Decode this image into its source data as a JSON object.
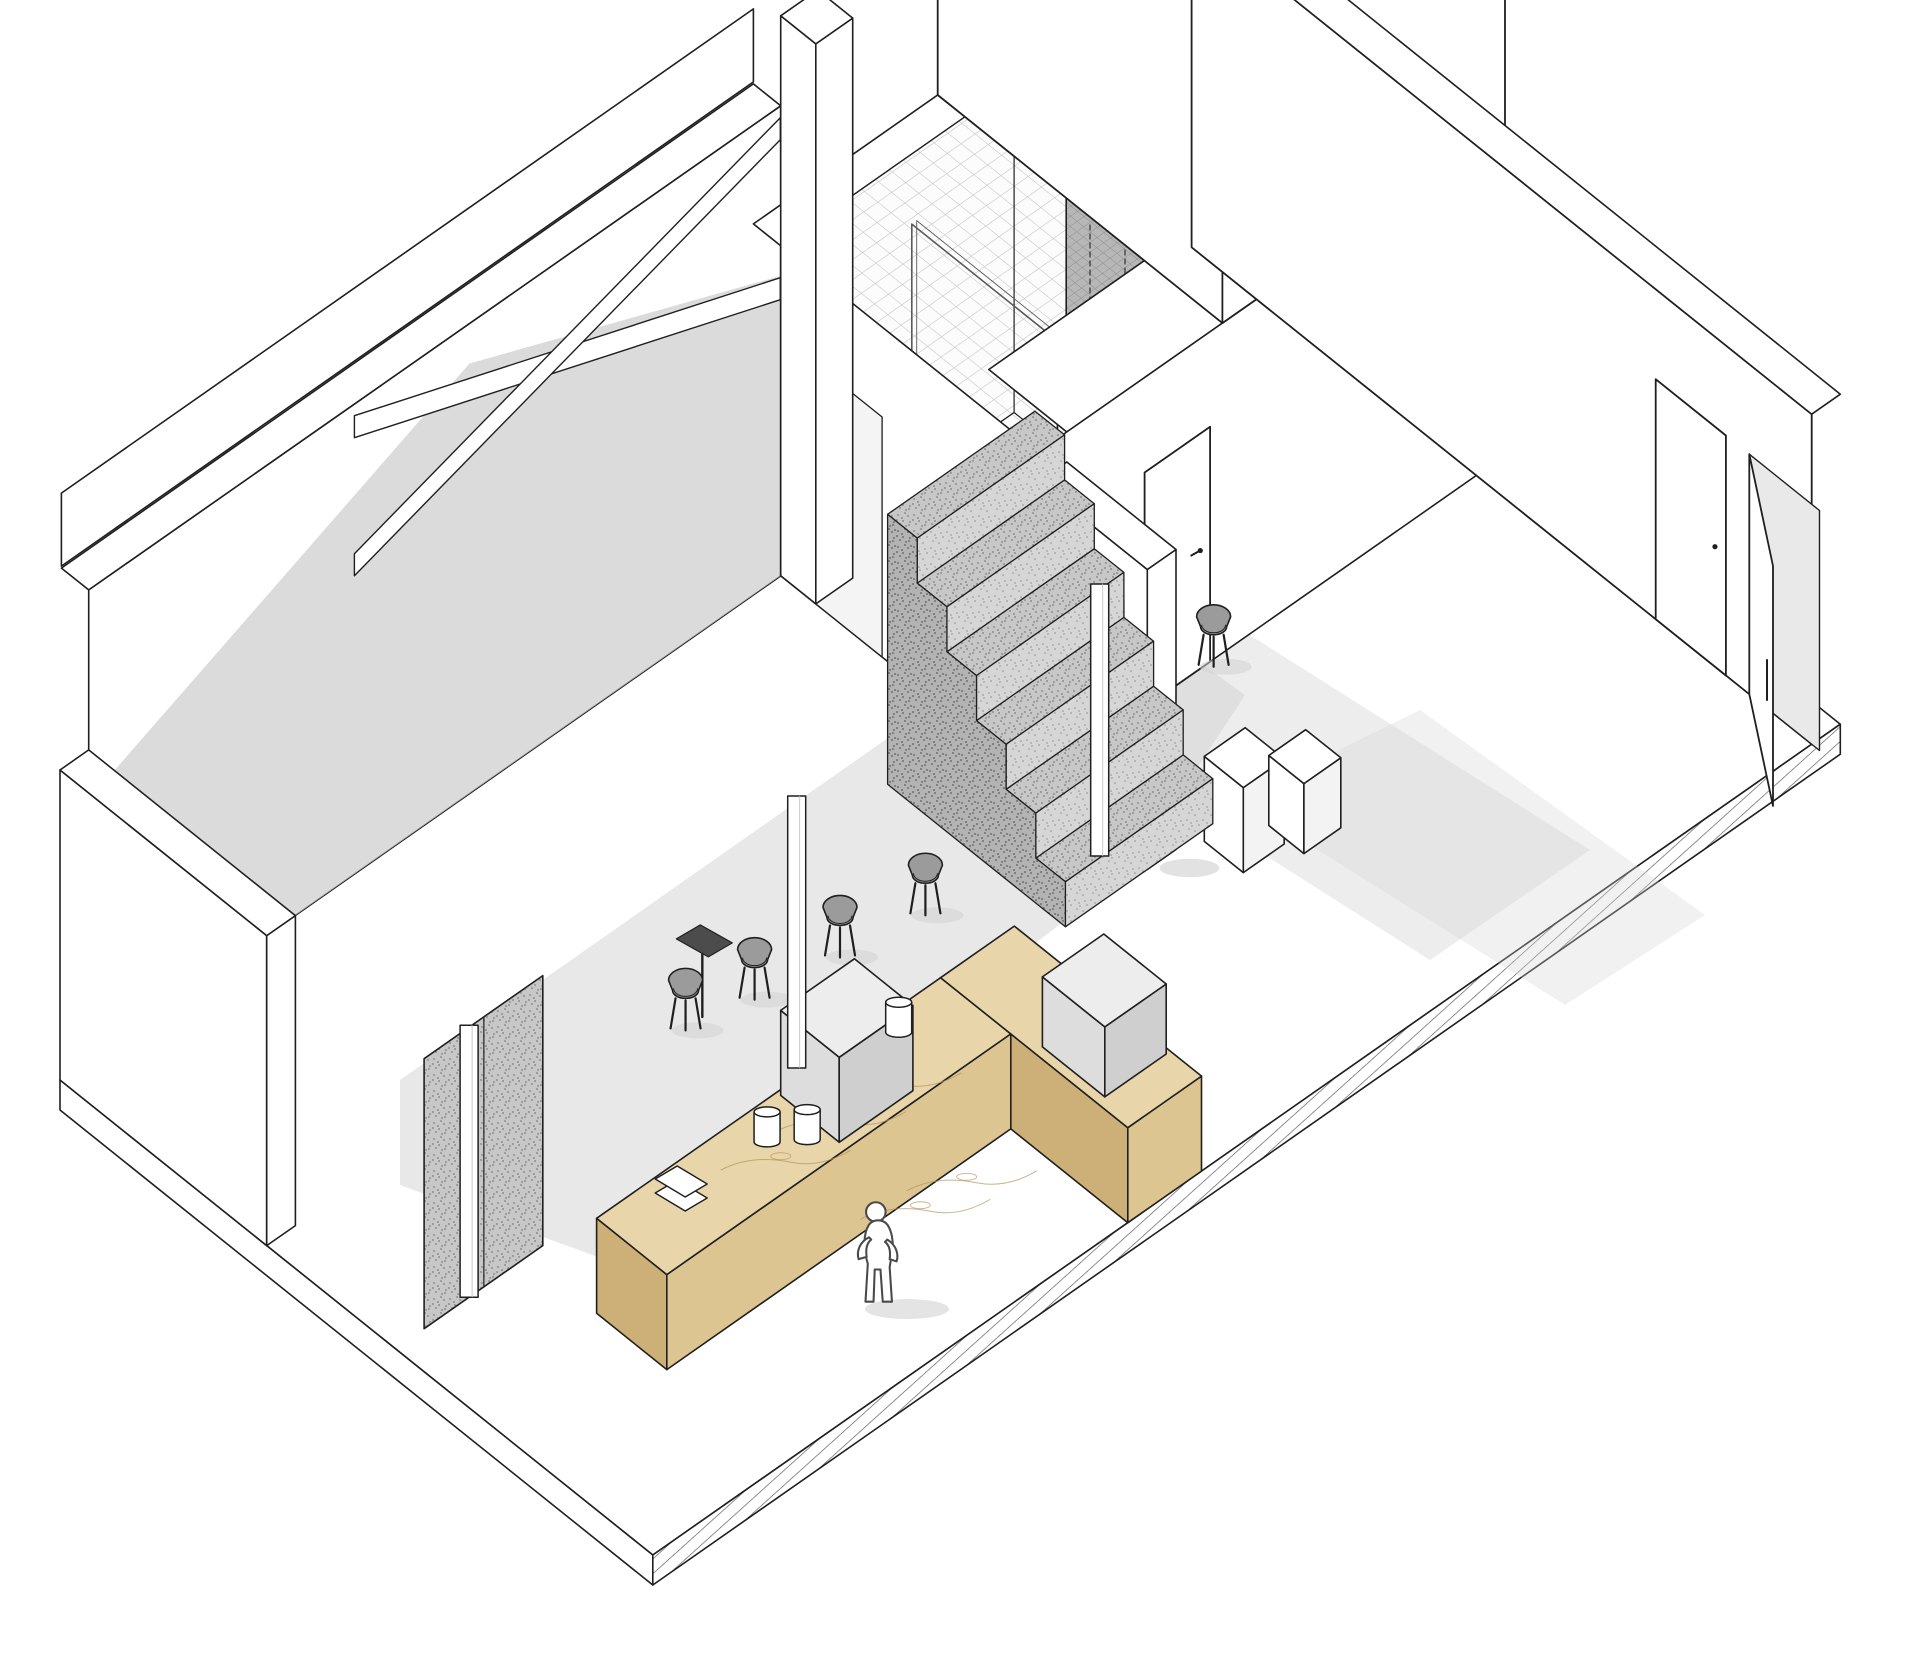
{
  "page": {
    "background": "#ffffff",
    "width": 1920,
    "height": 1671
  },
  "drawing": {
    "type": "axonometric-cutaway",
    "subject": "Two-level cafe interior axonometric cutaway drawing",
    "style": "monochrome architectural line drawing with wood, tan and speckled concrete accents",
    "colors": {
      "line": "#1f1f1f",
      "soft_line": "#5a5a5a",
      "paper": "#ffffff",
      "shadow": "#d2d2d2",
      "wall_shade": "#cfcfcf",
      "wood_top": "#e8d5a9",
      "wood_front": "#ddc592",
      "wood_side": "#cdb077",
      "wood_grain": "#b2945c",
      "sofa_top": "#decdb8",
      "sofa_front": "#d3bfa6",
      "sofa_side": "#c3ac90",
      "concrete": "#c7c7c7",
      "concrete_light": "#d6d6d6",
      "concrete_dark": "#b3b3b3",
      "speckle": "#7f7f7f",
      "floor_tile_bg": "#fcfcfc",
      "tile_line": "#c6c6c6",
      "tile_gray": "#b7b7b7",
      "tile_gray_line": "#8f8f8f",
      "chair_shell": "#9b9b9b",
      "glass": "#ededed",
      "figure": "#ffffff",
      "figure_line": "#4a4a4a",
      "cable": "#9a9a9a",
      "machine_top": "#ededed",
      "machine_left": "#dddddd",
      "machine_front": "#cfcfcf"
    },
    "inventory": {
      "levels": 2,
      "plants": 9,
      "bar_stools": 9,
      "dining_chairs": 6,
      "human_figures": 3,
      "showers": 2,
      "doors_closed": 3,
      "doors_open": 1,
      "staircases": 2,
      "features": [
        "floor slab with hatched front edge",
        "cut back wall shown as white band",
        "diagonal roof truss braces",
        "mezzanine deck with cable railing",
        "long communal wood table with round-back stools",
        "L-shaped tan booth sofa with wood pedestal table",
        "floor opening with concrete stair",
        "concrete stair rising under mezzanine",
        "L-shaped wood service counter with espresso machines",
        "tiled shower rooms with two showers and glass screen",
        "gray mosaic tile shower volume",
        "large white roof volume",
        "concrete stair block with bench nook and railing",
        "round stem tables",
        "potted monstera plants",
        "white doors and one open entry door"
      ]
    }
  }
}
